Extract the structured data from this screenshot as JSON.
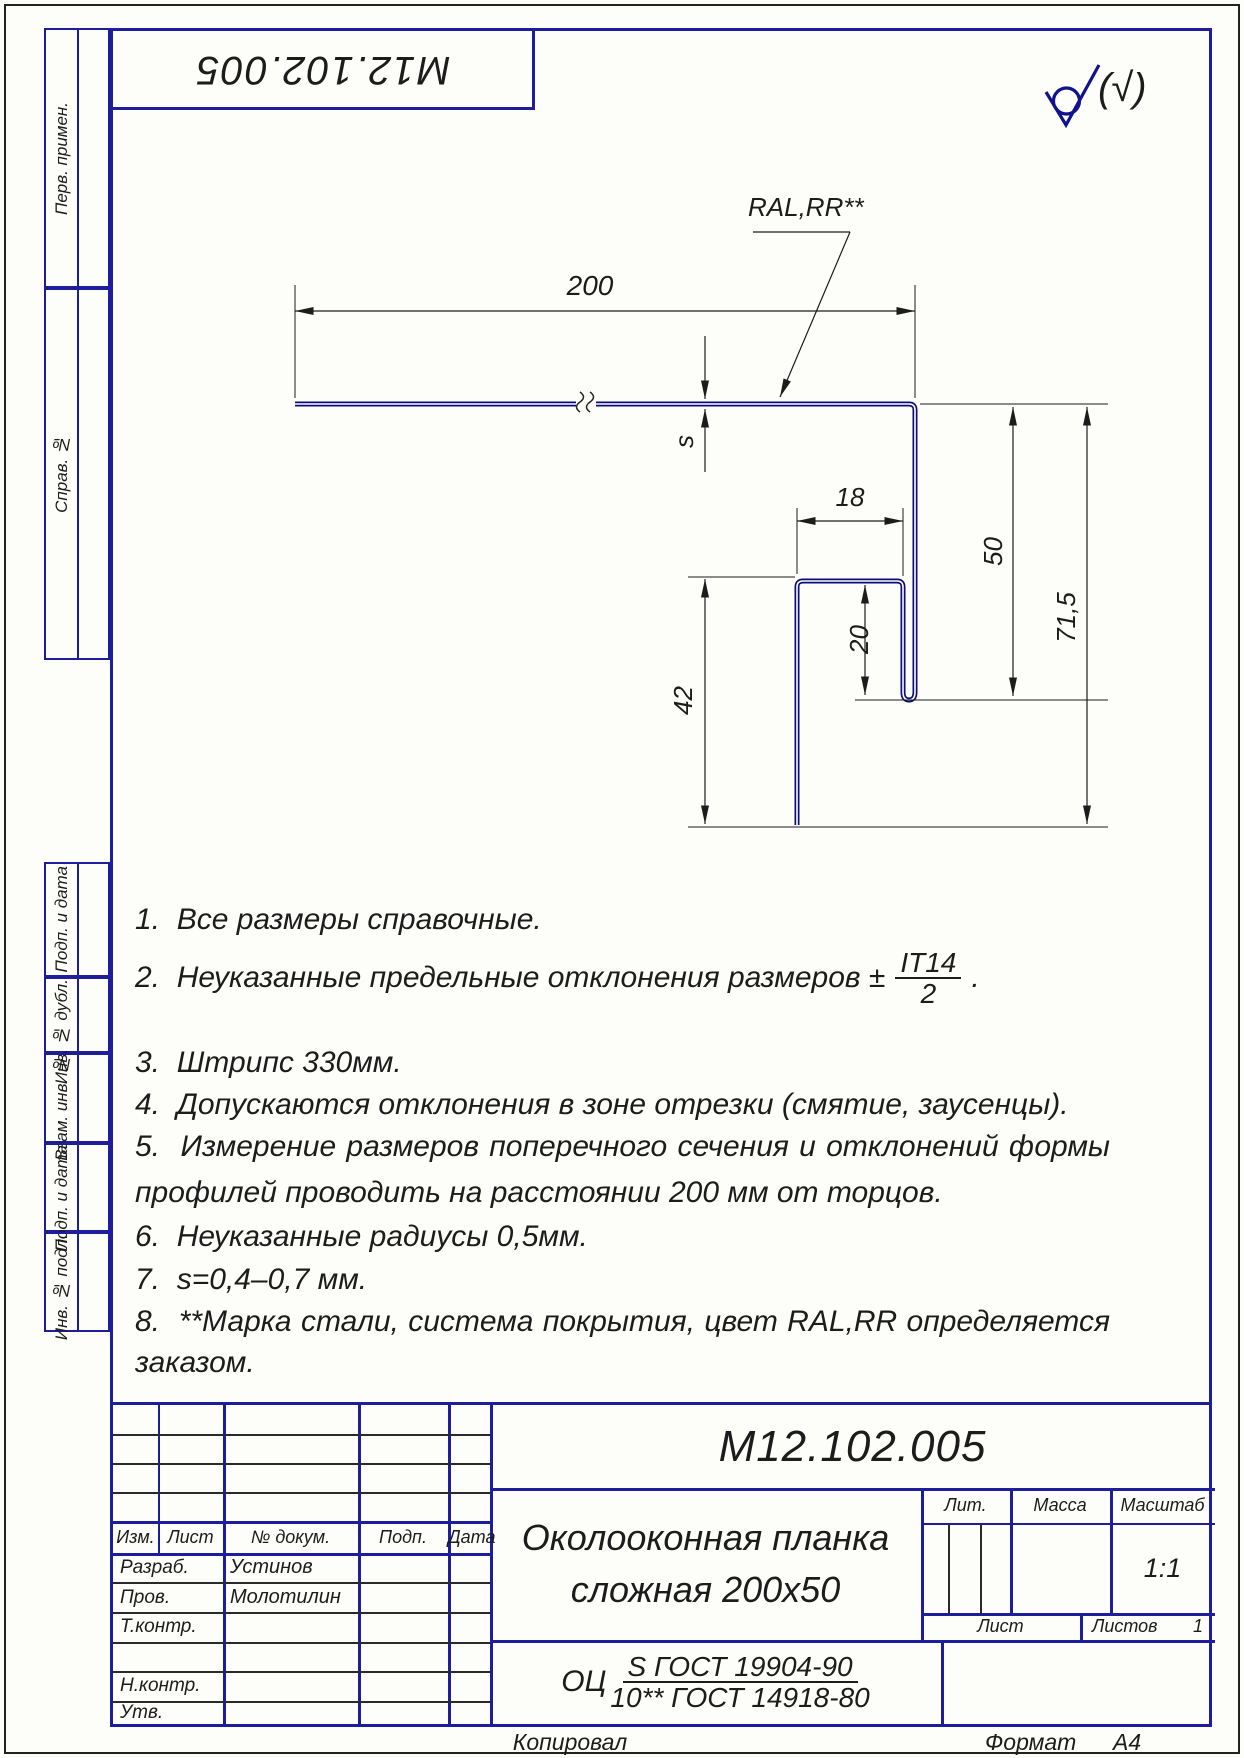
{
  "stamp_top": "М12.102.005",
  "roughness": {
    "note": "(√)"
  },
  "drawing": {
    "dims": {
      "width": "200",
      "flange": "18",
      "lip": "20",
      "leg": "42",
      "depth": "50",
      "total": "71,5",
      "thickness": "s",
      "coating": "RAL,RR**"
    }
  },
  "notes": {
    "n1": "1.  Все размеры справочные.",
    "n2_prefix": "2.  Неуказанные предельные отклонения размеров ±",
    "n2_frac_num": "IT14",
    "n2_frac_den": "2",
    "n2_suffix": ".",
    "n3": "3.  Штрипс 330мм.",
    "n4": "4.  Допускаются отклонения в зоне отрезки (смятие, заусенцы).",
    "n5a": "5.  Измерение размеров поперечного сечения и отклонений формы",
    "n5b": "профилей проводить на расстоянии 200 мм от торцов.",
    "n6": "6.  Неуказанные радиусы 0,5мм.",
    "n7": "7.  s=0,4–0,7 мм.",
    "n8a": "8.  **Марка стали, система покрытия, цвет RAL,RR определяется",
    "n8b": "заказом."
  },
  "margin": {
    "labels": [
      "Перв. примен.",
      "Справ. №",
      "Подп. и дата",
      "Инв. № дубл.",
      "Взам. инв. №",
      "Подп. и дата",
      "Инв. № подл."
    ]
  },
  "titleblock": {
    "designation": "М12.102.005",
    "title1": "Околооконная планка",
    "title2": "сложная 200x50",
    "material_prefix": "ОЦ",
    "material_num": "S ГОСТ 19904-90",
    "material_den": "10** ГОСТ 14918-80",
    "header": {
      "izm": "Изм.",
      "list": "Лист",
      "doc": "№ докум.",
      "sign": "Подп.",
      "date": "Дата"
    },
    "roles": {
      "dev": "Разраб.",
      "check": "Пров.",
      "tcontr": "Т.контр.",
      "ncontr": "Н.контр.",
      "approve": "Утв."
    },
    "names": {
      "dev": "Устинов",
      "check": "Молотилин"
    },
    "lit_label": "Лит.",
    "mass_label": "Масса",
    "scale_label": "Масштаб",
    "scale_value": "1:1",
    "sheet_label": "Лист",
    "sheets_label": "Листов",
    "sheets_value": "1"
  },
  "footer": {
    "copied": "Копировал",
    "format_label": "Формат",
    "format_value": "А4"
  }
}
